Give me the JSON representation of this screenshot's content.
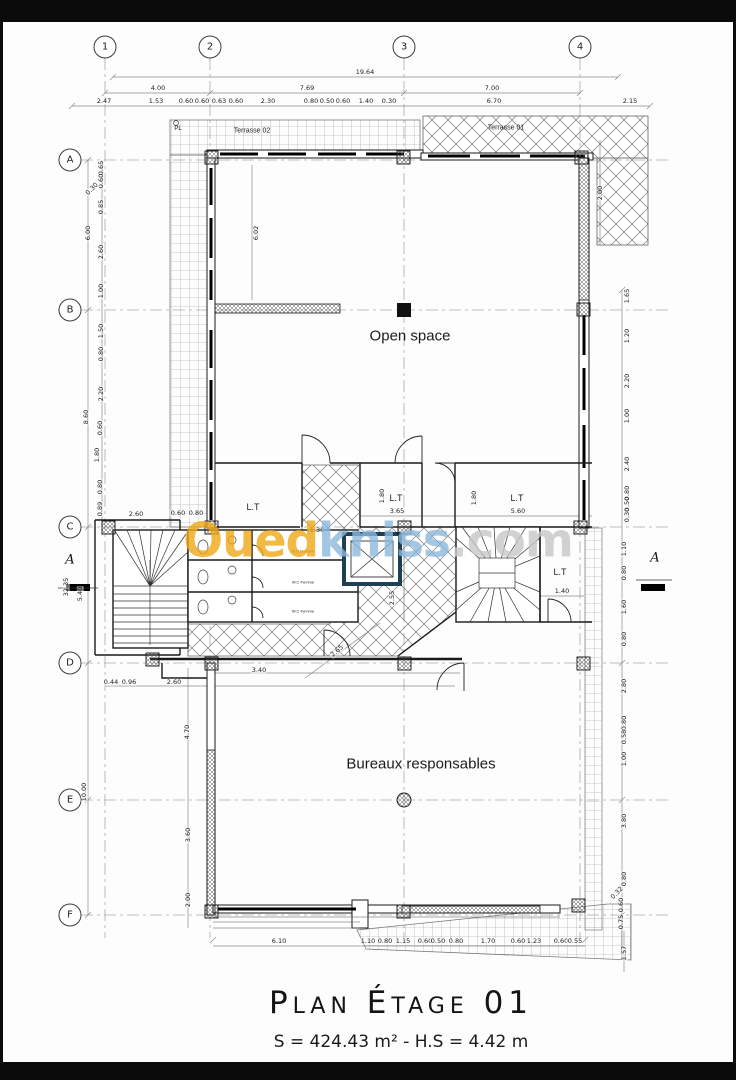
{
  "sheet": {
    "background": "#fdfdfd",
    "frame_color": "#0b0b0b"
  },
  "title_block": {
    "title": "Plan Étage 01",
    "subtitle": "S = 424.43 m² - H.S = 4.42 m"
  },
  "watermark": {
    "part1": "Oued",
    "part2": "kniss",
    "part3": ".com",
    "color1": "#efa816",
    "color2": "#8db9dd",
    "color3": "#c7c7c7"
  },
  "grid": {
    "cols": [
      {
        "label": "1",
        "x": 105
      },
      {
        "label": "2",
        "x": 210
      },
      {
        "label": "3",
        "x": 404
      },
      {
        "label": "4",
        "x": 580
      }
    ],
    "col_y": 47,
    "rows": [
      {
        "label": "A",
        "y": 160
      },
      {
        "label": "B",
        "y": 310
      },
      {
        "label": "C",
        "y": 527
      },
      {
        "label": "D",
        "y": 663
      },
      {
        "label": "E",
        "y": 800
      },
      {
        "label": "F",
        "y": 915
      }
    ],
    "row_x": 70
  },
  "sections": [
    {
      "label": "A",
      "x": 70,
      "y": 560
    },
    {
      "label": "A",
      "x": 655,
      "y": 558
    }
  ],
  "labels": [
    {
      "t": "PL",
      "x": 178,
      "y": 129,
      "s": 6
    },
    {
      "t": "Terrasse 02",
      "x": 252,
      "y": 131,
      "s": 7
    },
    {
      "t": "Terrasse 01",
      "x": 506,
      "y": 128,
      "s": 7
    },
    {
      "t": "Open space",
      "x": 410,
      "y": 336,
      "s": 15
    },
    {
      "t": "L.T",
      "x": 253,
      "y": 507,
      "s": 9
    },
    {
      "t": "L.T",
      "x": 396,
      "y": 498,
      "s": 9
    },
    {
      "t": "L.T",
      "x": 517,
      "y": 498,
      "s": 9
    },
    {
      "t": "L.T",
      "x": 560,
      "y": 572,
      "s": 9
    },
    {
      "t": "W.C Homme",
      "x": 303,
      "y": 551,
      "s": 4
    },
    {
      "t": "W.C Femme",
      "x": 303,
      "y": 582,
      "s": 4
    },
    {
      "t": "W.C Femme",
      "x": 303,
      "y": 611,
      "s": 4
    },
    {
      "t": "Bureaux responsables",
      "x": 421,
      "y": 764,
      "s": 15
    }
  ],
  "dims": [
    {
      "t": "19.64",
      "x": 365,
      "y": 72
    },
    {
      "t": "4.00",
      "x": 158,
      "y": 88
    },
    {
      "t": "7.69",
      "x": 307,
      "y": 88
    },
    {
      "t": "7.00",
      "x": 492,
      "y": 88
    },
    {
      "t": "2.47",
      "x": 104,
      "y": 101
    },
    {
      "t": "1.53",
      "x": 156,
      "y": 101
    },
    {
      "t": "0.60",
      "x": 186,
      "y": 101
    },
    {
      "t": "0.60",
      "x": 202,
      "y": 101
    },
    {
      "t": "0.63",
      "x": 219,
      "y": 101
    },
    {
      "t": "0.60",
      "x": 236,
      "y": 101
    },
    {
      "t": "2.30",
      "x": 268,
      "y": 101
    },
    {
      "t": "0.80",
      "x": 311,
      "y": 101
    },
    {
      "t": "0.50",
      "x": 327,
      "y": 101
    },
    {
      "t": "0.60",
      "x": 343,
      "y": 101
    },
    {
      "t": "1.40",
      "x": 366,
      "y": 101
    },
    {
      "t": "0.30",
      "x": 389,
      "y": 101
    },
    {
      "t": "6.70",
      "x": 494,
      "y": 101
    },
    {
      "t": "2.15",
      "x": 630,
      "y": 101
    },
    {
      "t": "2.00",
      "x": 600,
      "y": 193,
      "r": -90
    },
    {
      "t": "6.00",
      "x": 88,
      "y": 233,
      "r": -90
    },
    {
      "t": "8.60",
      "x": 86,
      "y": 417,
      "r": -90
    },
    {
      "t": "32.35",
      "x": 66,
      "y": 587,
      "r": -90
    },
    {
      "t": "5.40",
      "x": 80,
      "y": 594,
      "r": -90
    },
    {
      "t": "10.00",
      "x": 84,
      "y": 792,
      "r": -90
    },
    {
      "t": "0.65",
      "x": 101,
      "y": 168,
      "r": -90
    },
    {
      "t": "0.60",
      "x": 101,
      "y": 181,
      "r": -90
    },
    {
      "t": "0.30",
      "x": 92,
      "y": 189,
      "r": -45
    },
    {
      "t": "0.85",
      "x": 101,
      "y": 207,
      "r": -90
    },
    {
      "t": "2.60",
      "x": 101,
      "y": 252,
      "r": -90
    },
    {
      "t": "1.00",
      "x": 101,
      "y": 291,
      "r": -90
    },
    {
      "t": "1.50",
      "x": 101,
      "y": 331,
      "r": -90
    },
    {
      "t": "0.80",
      "x": 101,
      "y": 354,
      "r": -90
    },
    {
      "t": "2.20",
      "x": 101,
      "y": 394,
      "r": -90
    },
    {
      "t": "0.60",
      "x": 100,
      "y": 428,
      "r": -90
    },
    {
      "t": "1.80",
      "x": 97,
      "y": 455,
      "r": -90
    },
    {
      "t": "0.80",
      "x": 100,
      "y": 487,
      "r": -90
    },
    {
      "t": "0.89",
      "x": 100,
      "y": 509,
      "r": -90
    },
    {
      "t": "2.60",
      "x": 136,
      "y": 514
    },
    {
      "t": "0.60",
      "x": 178,
      "y": 513
    },
    {
      "t": "0.80",
      "x": 196,
      "y": 513
    },
    {
      "t": "6.02",
      "x": 256,
      "y": 233,
      "r": -90
    },
    {
      "t": "1.30",
      "x": 317,
      "y": 530
    },
    {
      "t": "3.65",
      "x": 397,
      "y": 511
    },
    {
      "t": "5.60",
      "x": 518,
      "y": 511
    },
    {
      "t": "1.80",
      "x": 382,
      "y": 496,
      "r": -90
    },
    {
      "t": "1.80",
      "x": 474,
      "y": 498,
      "r": -90
    },
    {
      "t": "1.40",
      "x": 562,
      "y": 591
    },
    {
      "t": "2.55",
      "x": 392,
      "y": 598,
      "r": -90
    },
    {
      "t": "2.65",
      "x": 337,
      "y": 651,
      "r": -40
    },
    {
      "t": "3.40",
      "x": 259,
      "y": 670
    },
    {
      "t": "0.44",
      "x": 111,
      "y": 682
    },
    {
      "t": "0.96",
      "x": 129,
      "y": 682
    },
    {
      "t": "2.60",
      "x": 174,
      "y": 682
    },
    {
      "t": "4.70",
      "x": 187,
      "y": 732,
      "r": -90
    },
    {
      "t": "3.60",
      "x": 188,
      "y": 835,
      "r": -90
    },
    {
      "t": "2.00",
      "x": 188,
      "y": 900,
      "r": -90
    },
    {
      "t": "6.10",
      "x": 279,
      "y": 941
    },
    {
      "t": "1.10",
      "x": 368,
      "y": 941
    },
    {
      "t": "0.80",
      "x": 385,
      "y": 941
    },
    {
      "t": "1.15",
      "x": 403,
      "y": 941
    },
    {
      "t": "0.60",
      "x": 425,
      "y": 941
    },
    {
      "t": "0.50",
      "x": 438,
      "y": 941
    },
    {
      "t": "0.80",
      "x": 456,
      "y": 941
    },
    {
      "t": "1.70",
      "x": 488,
      "y": 941
    },
    {
      "t": "0.60",
      "x": 518,
      "y": 941
    },
    {
      "t": "1.23",
      "x": 534,
      "y": 941
    },
    {
      "t": "0.60",
      "x": 561,
      "y": 941
    },
    {
      "t": "0.55",
      "x": 575,
      "y": 941
    },
    {
      "t": "1.65",
      "x": 627,
      "y": 296,
      "r": -90
    },
    {
      "t": "1.20",
      "x": 627,
      "y": 336,
      "r": -90
    },
    {
      "t": "2.20",
      "x": 627,
      "y": 381,
      "r": -90
    },
    {
      "t": "1.00",
      "x": 627,
      "y": 416,
      "r": -90
    },
    {
      "t": "2.40",
      "x": 627,
      "y": 464,
      "r": -90
    },
    {
      "t": "0.80",
      "x": 627,
      "y": 493,
      "r": -90
    },
    {
      "t": "0.50",
      "x": 627,
      "y": 504,
      "r": -90
    },
    {
      "t": "0.30",
      "x": 627,
      "y": 515,
      "r": -90
    },
    {
      "t": "1.10",
      "x": 624,
      "y": 549,
      "r": -90
    },
    {
      "t": "0.80",
      "x": 624,
      "y": 573,
      "r": -90
    },
    {
      "t": "1.60",
      "x": 624,
      "y": 607,
      "r": -90
    },
    {
      "t": "0.80",
      "x": 624,
      "y": 639,
      "r": -90
    },
    {
      "t": "2.80",
      "x": 624,
      "y": 686,
      "r": -90
    },
    {
      "t": "0.80",
      "x": 624,
      "y": 723,
      "r": -90
    },
    {
      "t": "0.58",
      "x": 624,
      "y": 737,
      "r": -90
    },
    {
      "t": "1.00",
      "x": 624,
      "y": 759,
      "r": -90
    },
    {
      "t": "3.80",
      "x": 624,
      "y": 821,
      "r": -90
    },
    {
      "t": "0.80",
      "x": 624,
      "y": 879,
      "r": -90
    },
    {
      "t": "0.32",
      "x": 617,
      "y": 893,
      "r": -45
    },
    {
      "t": "0.60",
      "x": 621,
      "y": 905,
      "r": -90
    },
    {
      "t": "0.75",
      "x": 621,
      "y": 922,
      "r": -90
    },
    {
      "t": "1.57",
      "x": 624,
      "y": 953,
      "r": -90
    }
  ],
  "elevator_color": "#1d4052"
}
